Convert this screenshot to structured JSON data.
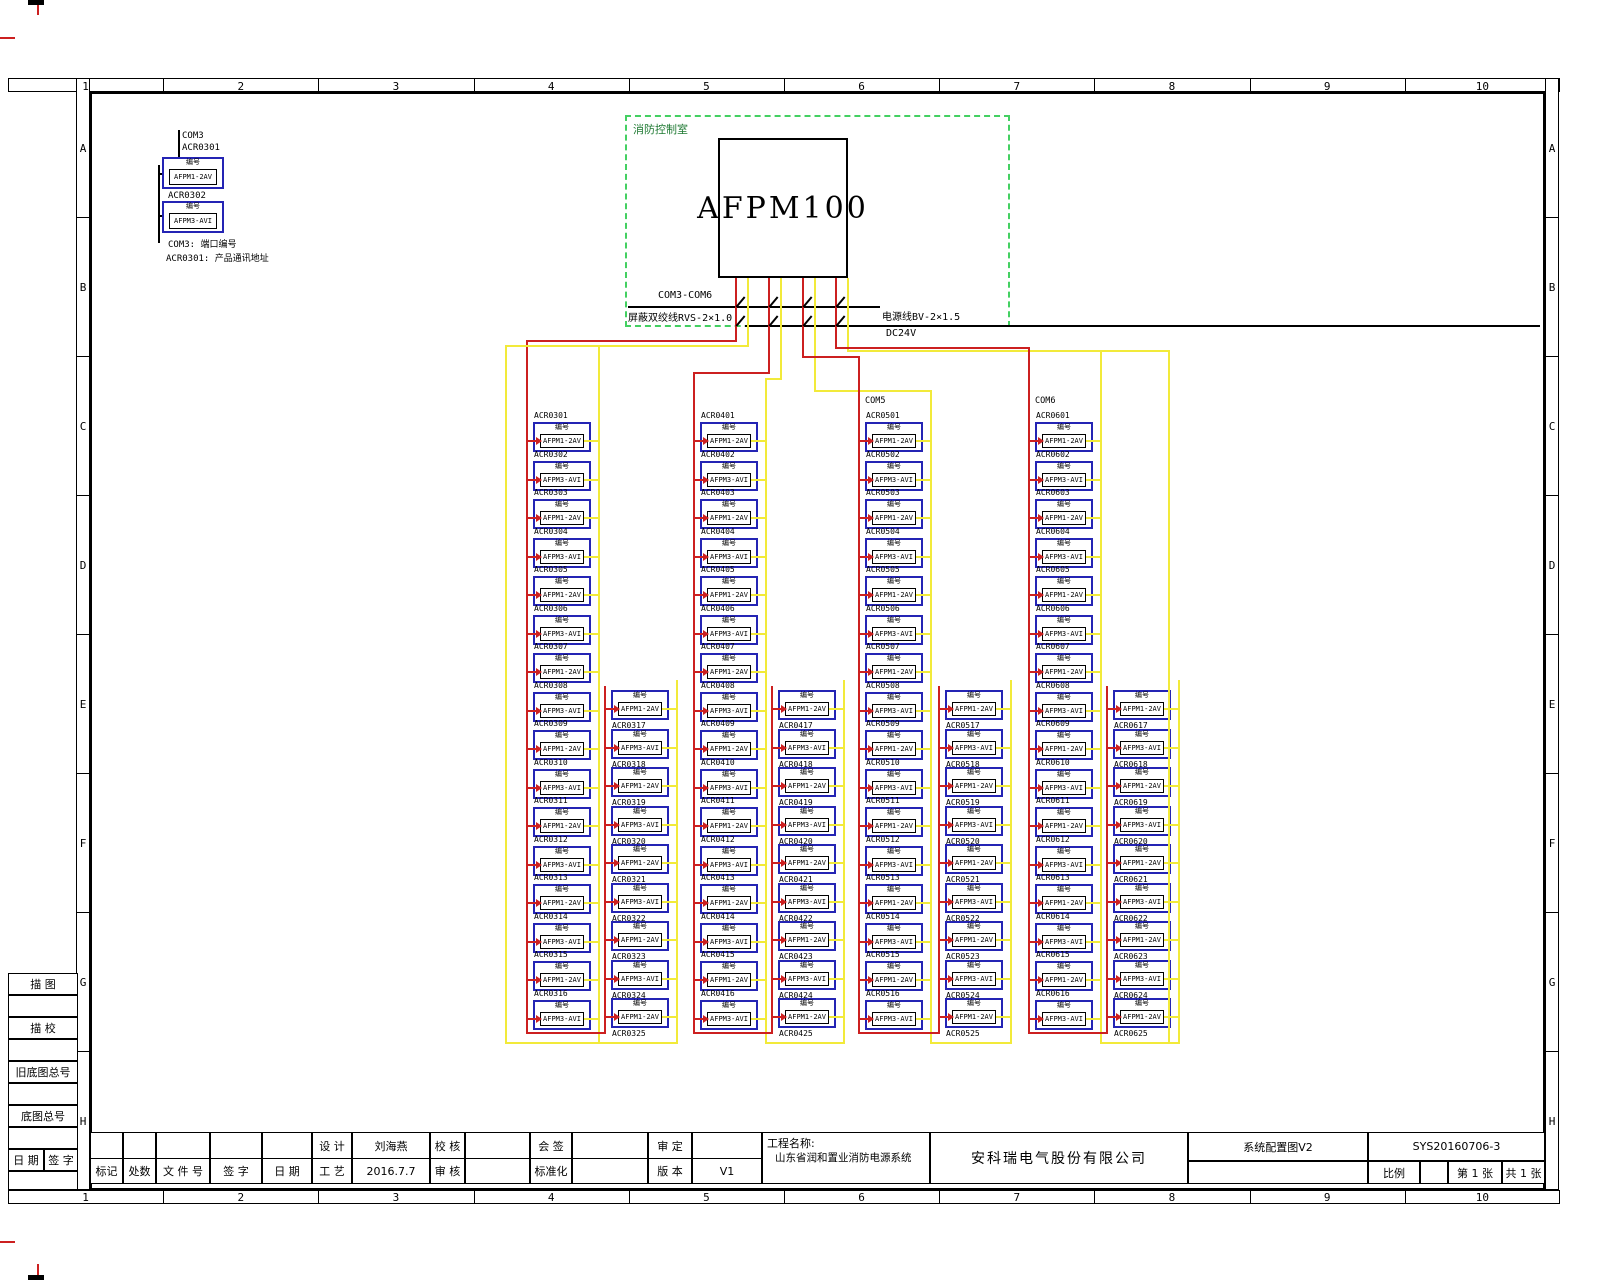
{
  "sheet": {
    "grid_numbers": [
      "1",
      "2",
      "3",
      "4",
      "5",
      "6",
      "7",
      "8",
      "9",
      "10"
    ],
    "grid_letters": [
      "A",
      "B",
      "C",
      "D",
      "E",
      "F",
      "G",
      "H"
    ]
  },
  "control_room": {
    "label": "消防控制室",
    "device": "AFPM100"
  },
  "bus": {
    "com_range": "COM3-COM6",
    "signal_cable": "屏蔽双绞线RVS-2×1.0",
    "power_cable": "电源线BV-2×1.5",
    "power_voltage": "DC24V"
  },
  "legend": {
    "com": "COM3",
    "addr1": "ACR0301",
    "addr2": "ACR0302",
    "note1": "COM3: 端口编号",
    "note2": "ACR0301: 产品通讯地址"
  },
  "device_tag": "编号",
  "model_cycle": [
    "AFPM1-2AV",
    "AFPM3-AVI"
  ],
  "colors": {
    "signal_wire": "#cc2020",
    "power_wire": "#f2ea3a",
    "device_outline": "#2424b4",
    "room_outline": "#44d062"
  },
  "groups": [
    {
      "com": "",
      "main_ids": [
        "ACR0301",
        "ACR0302",
        "ACR0303",
        "ACR0304",
        "ACR0305",
        "ACR0306",
        "ACR0307",
        "ACR0308",
        "ACR0309",
        "ACR0310",
        "ACR0311",
        "ACR0312",
        "ACR0313",
        "ACR0314",
        "ACR0315",
        "ACR0316"
      ],
      "sub_ids": [
        "ACR0317",
        "ACR0318",
        "ACR0319",
        "ACR0320",
        "ACR0321",
        "ACR0322",
        "ACR0323",
        "ACR0324",
        "ACR0325"
      ]
    },
    {
      "com": "",
      "main_ids": [
        "ACR0401",
        "ACR0402",
        "ACR0403",
        "ACR0404",
        "ACR0405",
        "ACR0406",
        "ACR0407",
        "ACR0408",
        "ACR0409",
        "ACR0410",
        "ACR0411",
        "ACR0412",
        "ACR0413",
        "ACR0414",
        "ACR0415",
        "ACR0416"
      ],
      "sub_ids": [
        "ACR0417",
        "ACR0418",
        "ACR0419",
        "ACR0420",
        "ACR0421",
        "ACR0422",
        "ACR0423",
        "ACR0424",
        "ACR0425"
      ]
    },
    {
      "com": "COM5",
      "main_ids": [
        "ACR0501",
        "ACR0502",
        "ACR0503",
        "ACR0504",
        "ACR0505",
        "ACR0506",
        "ACR0507",
        "ACR0508",
        "ACR0509",
        "ACR0510",
        "ACR0511",
        "ACR0512",
        "ACR0513",
        "ACR0514",
        "ACR0515",
        "ACR0516"
      ],
      "sub_ids": [
        "ACR0517",
        "ACR0518",
        "ACR0519",
        "ACR0520",
        "ACR0521",
        "ACR0522",
        "ACR0523",
        "ACR0524",
        "ACR0525"
      ]
    },
    {
      "com": "COM6",
      "main_ids": [
        "ACR0601",
        "ACR0602",
        "ACR0603",
        "ACR0604",
        "ACR0605",
        "ACR0606",
        "ACR0607",
        "ACR0608",
        "ACR0609",
        "ACR0610",
        "ACR0611",
        "ACR0612",
        "ACR0613",
        "ACR0614",
        "ACR0615",
        "ACR0616"
      ],
      "sub_ids": [
        "ACR0617",
        "ACR0618",
        "ACR0619",
        "ACR0620",
        "ACR0621",
        "ACR0622",
        "ACR0623",
        "ACR0624",
        "ACR0625"
      ]
    }
  ],
  "title_block": {
    "design_label": "设 计",
    "design_name": "刘海燕",
    "check_label": "校 核",
    "countersign_label": "会 签",
    "approve_label": "审 定",
    "mark_label": "标记",
    "count_label": "处数",
    "file_no_label": "文 件 号",
    "sign_label": "签 字",
    "date_label": "日 期",
    "craft_label": "工 艺",
    "design_date": "2016.7.7",
    "audit_label": "审 核",
    "standard_label": "标准化",
    "version_label": "版 本",
    "version": "V1",
    "project_label": "工程名称:",
    "project_name": "山东省润和置业消防电源系统",
    "company": "安科瑞电气股份有限公司",
    "drawing_title": "系统配置图V2",
    "drawing_no": "SYS20160706-3",
    "scale_label": "比例",
    "sheet_no": "第 1 张",
    "sheet_total": "共 1 张"
  },
  "margin_fields": {
    "tracing": "描    图",
    "tracing_check": "描    校",
    "old_base_no": "旧底图总号",
    "base_no": "底图总号",
    "date": "日 期",
    "sign": "签 字"
  }
}
